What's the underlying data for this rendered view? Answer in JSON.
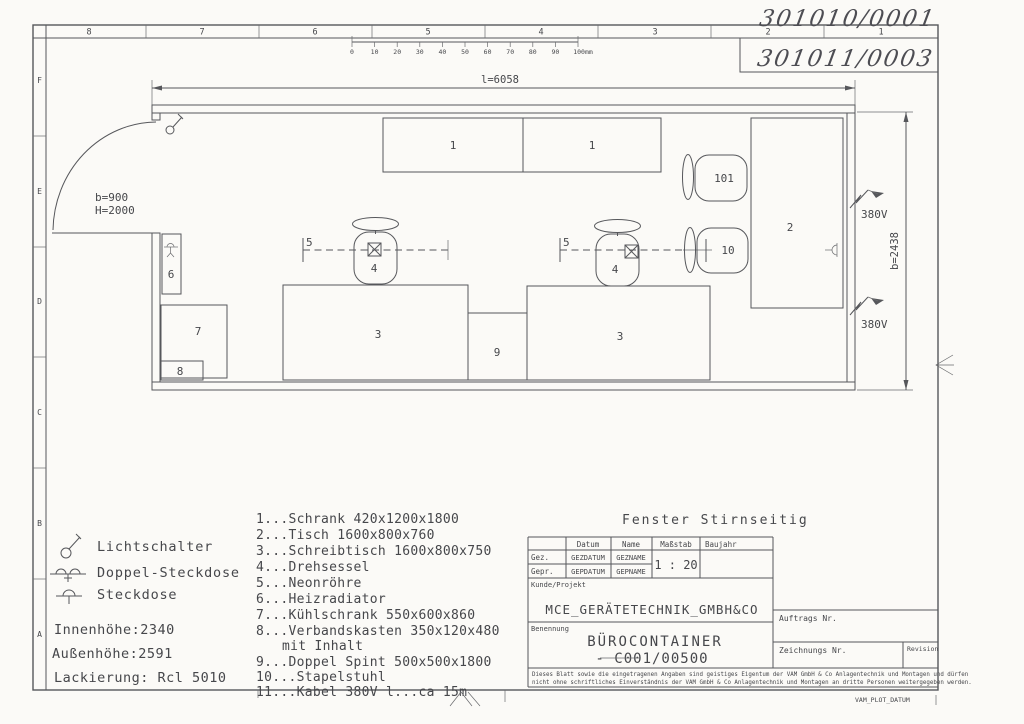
{
  "frame": {
    "top_numbers": [
      "8",
      "7",
      "6",
      "5",
      "4",
      "3",
      "2",
      "1"
    ],
    "left_letters": [
      "F",
      "E",
      "D",
      "C",
      "B",
      "A"
    ],
    "handwritten_upper": "301010/0001",
    "handwritten_lower": "301011/0003",
    "plot_code": "VAM_PLOT_DATUM"
  },
  "ruler": {
    "labels": [
      "0",
      "10",
      "20",
      "30",
      "40",
      "50",
      "60",
      "70",
      "80",
      "90",
      "100mm"
    ]
  },
  "plan": {
    "dim_length": "l=6058",
    "dim_width": "b=2438",
    "door_width": "b=900",
    "door_height": "H=2000",
    "voltage": "380V",
    "labels": {
      "cabinet_left": "1",
      "cabinet_right": "1",
      "table": "2",
      "desk_left": "3",
      "desk_right": "3",
      "chair_left": "4",
      "chair_right": "4",
      "neon_left": "5",
      "neon_right": "5",
      "radiator": "6",
      "fridge": "7",
      "first_aid_box": "8",
      "locker": "9",
      "stack_chair_front": "10",
      "stack_chair_back": "101"
    }
  },
  "legend": {
    "light_switch": "Lichtschalter",
    "double_socket": "Doppel-Steckdose",
    "socket": "Steckdose"
  },
  "specs": {
    "inner_height": "Innenhöhe:2340",
    "outer_height": "Außenhöhe:2591",
    "paint": "Lackierung: Rcl 5010"
  },
  "parts_list": [
    "1...Schrank 420x1200x1800",
    "2...Tisch 1600x800x760",
    "3...Schreibtisch 1600x800x750",
    "4...Drehsessel",
    "5...Neonröhre",
    "6...Heizradiator",
    "7...Kühlschrank 550x600x860",
    "8...Verbandskasten 350x120x480",
    "mit Inhalt",
    "9...Doppel Spint 500x500x1800",
    "10...Stapelstuhl",
    "11...Kabel 380V l...ca 15m"
  ],
  "window_note": "Fenster Stirnseitig",
  "titleblock": {
    "header": {
      "datum": "Datum",
      "name": "Name",
      "massstab": "Maßstab",
      "baujahr": "Baujahr"
    },
    "gez": {
      "label": "Gez.",
      "datum": "GEZDATUM",
      "name": "GEZNAME"
    },
    "gepr": {
      "label": "Gepr.",
      "datum": "GEPDATUM",
      "name": "GEPNAME"
    },
    "scale": "1 : 20",
    "kunde_label": "Kunde/Projekt",
    "company": "MCE_GERÄTETECHNIK_GMBH&CO",
    "benennung_label": "Benennung",
    "title": "BÜROCONTAINER",
    "drawing_code": "- C001/00500",
    "auftrag_label": "Auftrags Nr.",
    "zeichnung_label": "Zeichnungs Nr.",
    "revision_label": "Revision",
    "disclaimer1": "Dieses Blatt sowie die eingetragenen Angaben sind geistiges Eigentum der VAM GmbH & Co Anlagentechnik und Montagen und dürfen",
    "disclaimer2": "nicht ohne schriftliches Einverständnis der VAM GmbH & Co Anlagentechnik und Montagen an dritte Personen weitergegeben werden."
  }
}
